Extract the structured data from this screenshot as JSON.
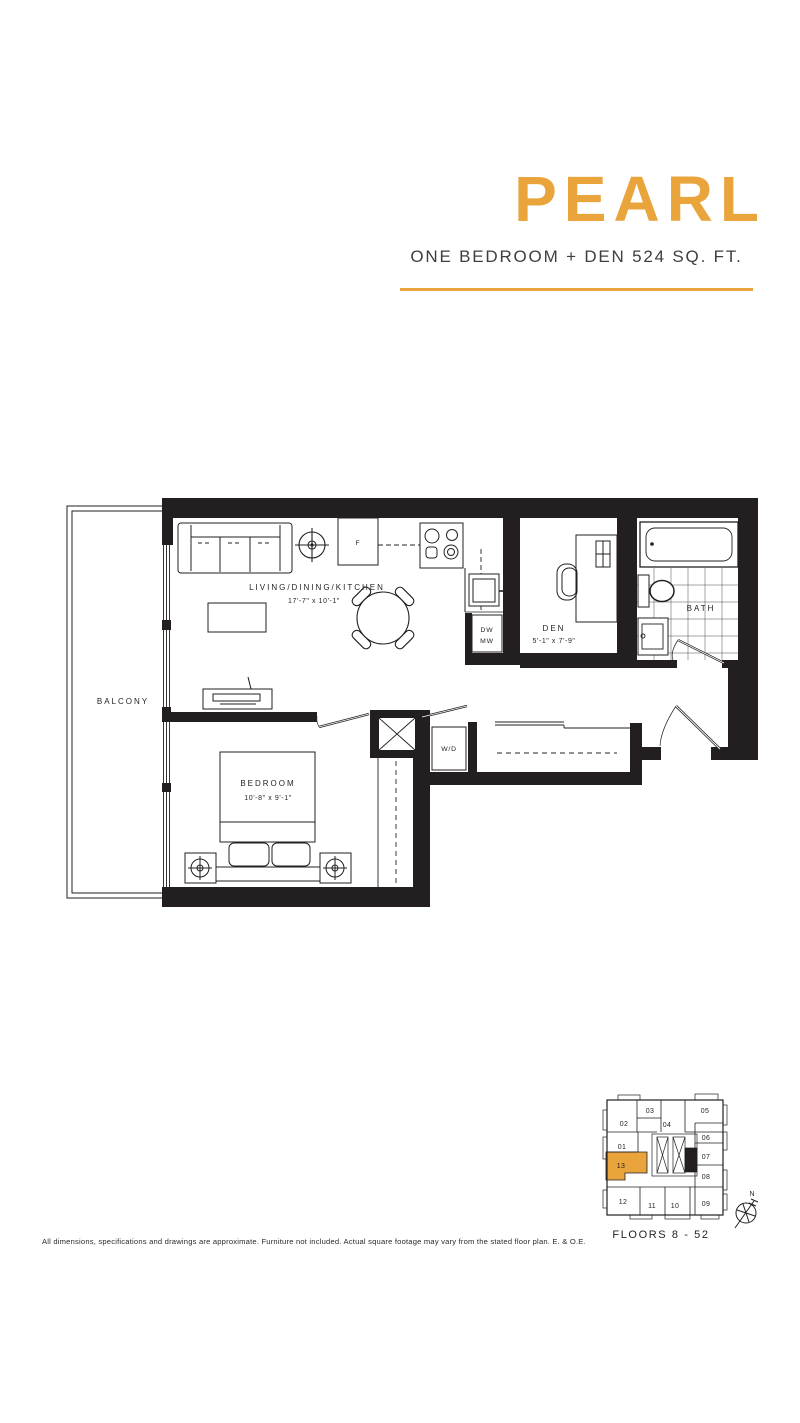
{
  "header": {
    "plan_name": "PEARL",
    "plan_subtitle": "ONE BEDROOM + DEN 524 SQ. FT."
  },
  "colors": {
    "accent": "#E9A43C",
    "ink": "#231F20"
  },
  "floor_plan": {
    "rooms": {
      "balcony": {
        "label": "BALCONY"
      },
      "living": {
        "label": "LIVING/DINING/KITCHEN",
        "dims": "17'-7\" x 10'-1\""
      },
      "den": {
        "label": "DEN",
        "dims": "5'-1\" x 7'-9\""
      },
      "bath": {
        "label": "BATH"
      },
      "bedroom": {
        "label": "BEDROOM",
        "dims": "10'-8\" x 9'-1\""
      }
    },
    "appliances": {
      "fridge": "F",
      "dishwasher": "DW",
      "microwave": "MW",
      "washer_dryer": "W/D"
    }
  },
  "key_plan": {
    "units": [
      "01",
      "02",
      "03",
      "04",
      "05",
      "06",
      "07",
      "08",
      "09",
      "10",
      "11",
      "12",
      "13"
    ],
    "highlighted_unit": "13",
    "floors_label": "FLOORS 8 - 52",
    "north_label": "N"
  },
  "footer": {
    "disclaimer": "All dimensions, specifications and drawings are approximate. Furniture not included. Actual square footage may vary from the stated floor plan. E. & O.E."
  }
}
